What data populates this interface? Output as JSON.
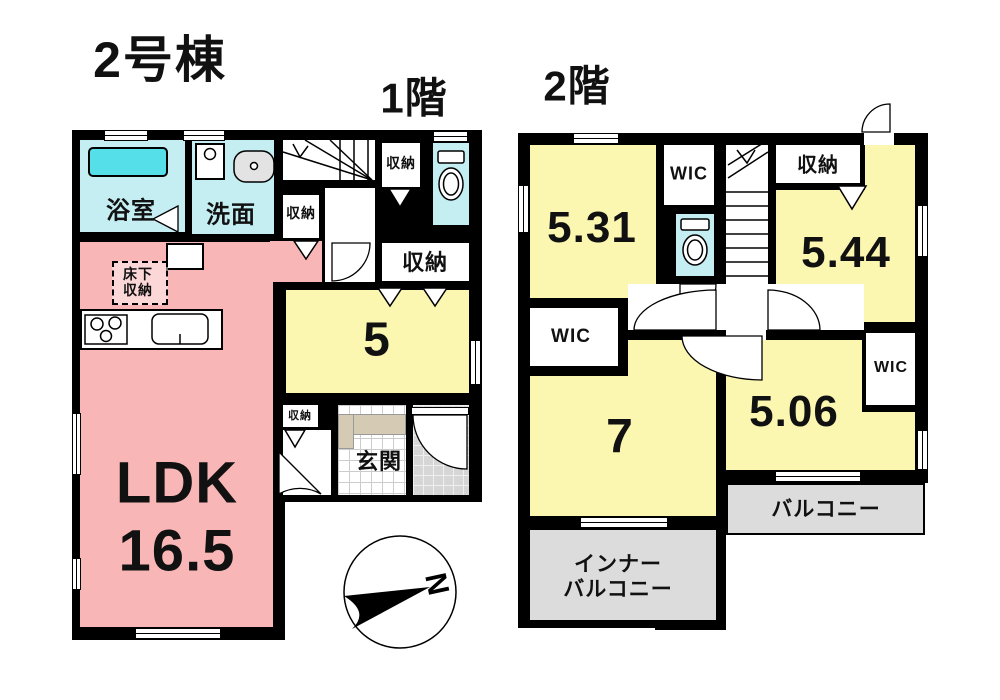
{
  "title": "2号棟",
  "floor1": {
    "label": "1階",
    "rooms": {
      "bath": "浴室",
      "washroom": "洗面",
      "closet_below_stairs": "収納",
      "closet_top_right": "収納",
      "closet_right": "収納",
      "room5": "5",
      "underfloor_line1": "床下",
      "underfloor_line2": "収納",
      "ldk": "LDK",
      "ldk_area": "16.5",
      "genkan": "玄関",
      "closet_bottom": "収納"
    }
  },
  "floor2": {
    "label": "2階",
    "rooms": {
      "room531": "5.31",
      "wic_top": "WIC",
      "closet_top": "収納",
      "room544": "5.44",
      "wic_left": "WIC",
      "room7": "7",
      "room506": "5.06",
      "wic_right": "WIC",
      "balcony": "バルコニー",
      "inner_balcony_line1": "インナー",
      "inner_balcony_line2": "バルコニー"
    }
  },
  "compass": {
    "north": "N"
  },
  "colors": {
    "ldk_pink": "#f9b6b6",
    "room_yellow": "#fbf6b0",
    "wet_cyan": "#c5eef3",
    "tub_cyan": "#55dfe9",
    "balcony_gray": "#dcdcdc",
    "shoe_cabinet_beige": "#d5cab4",
    "wall_black": "#000000"
  }
}
